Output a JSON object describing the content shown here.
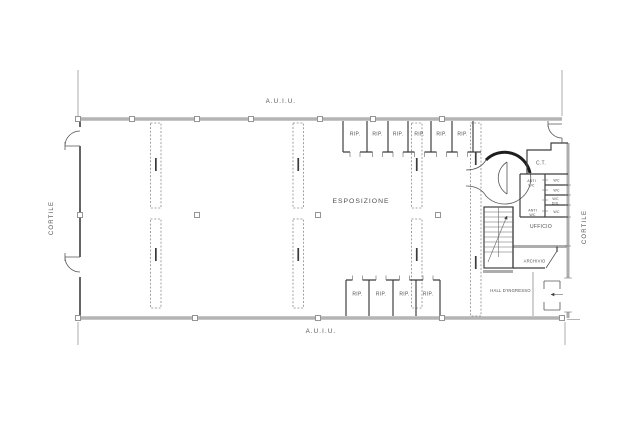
{
  "colors": {
    "wall_gray": "#b4b4b4",
    "line_dark": "#3f3f3f",
    "dash_gray": "#8a8a8a",
    "text_gray": "#4f4f4f",
    "background": "#ffffff"
  },
  "exterior": {
    "top_label": "A.U.I.U.",
    "bottom_label": "A.U.I.U.",
    "left_label": "CORTILE",
    "right_label": "CORTILE"
  },
  "rooms": {
    "exhibition": "ESPOSIZIONE",
    "office": "UFFICIO",
    "archive": "ARCHIVIO",
    "entrance_hall": "HALL D'INGRESSO",
    "heating_plant": "C.T.",
    "anti_wc_top_line1": "ANTI",
    "anti_wc_top_line2": "WC",
    "wc_1": "WC",
    "wc_2": "WC",
    "wc_dis_line1": "WC",
    "wc_dis_line2": "DIS.",
    "anti_wc_bottom_line1": "ANTI",
    "anti_wc_bottom_line2": "WC",
    "wc_3": "WC"
  },
  "storage_top": [
    "RIP.",
    "RIP.",
    "RIP.",
    "RIP.",
    "RIP.",
    "RIP."
  ],
  "storage_bottom": [
    "RIP.",
    "RIP.",
    "RIP.",
    "RIP."
  ]
}
